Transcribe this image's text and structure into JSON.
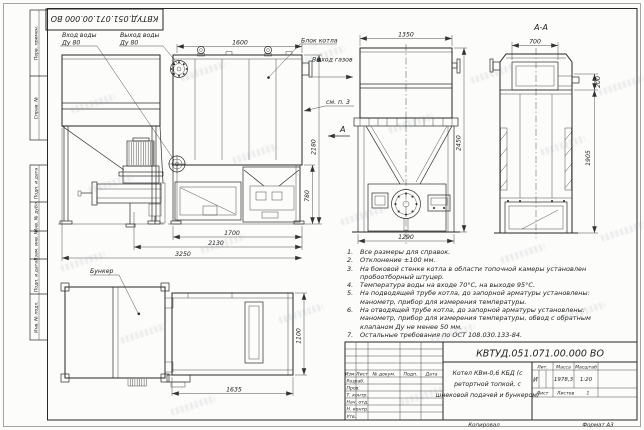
{
  "sheet": {
    "copied_label": "Копировал",
    "format_label": "Формат А3"
  },
  "margin": {
    "perv_primen": "Перв. примен.",
    "sprav_no": "Справ. №",
    "podp_data_1": "Подп. и дата",
    "inv_dubl": "Инв. № дубл.",
    "vzam_inv": "Взам. инв. №",
    "podp_data_2": "Подп. и дата",
    "inv_podl": "Инв. № подл."
  },
  "labels": {
    "water_in1": "Вход воды",
    "water_in2": "Ду 80",
    "water_out1": "Выход воды",
    "water_out2": "Ду 80",
    "block": "Блок котла",
    "gas": "Выход газов",
    "see": "см. п. 3",
    "section_mark": "А",
    "section_title": "А-А",
    "bunker": "Бункер"
  },
  "dims": {
    "d1600": "1600",
    "d1350": "1350",
    "d700": "700",
    "d200": "200",
    "d2450": "2450",
    "d1905": "1905",
    "d2180": "2180",
    "d780": "780",
    "d1700": "1700",
    "d2130": "2130",
    "d3250": "3250",
    "d1290": "1290",
    "d1635": "1635",
    "d1100": "1100"
  },
  "notes": {
    "items": [
      {
        "num": "1.",
        "text": "Все размеры для справок."
      },
      {
        "num": "2.",
        "text": "Отклонение ±100 мм."
      },
      {
        "num": "3.",
        "text": "На боковой стенке котла в области топочной камеры установлен\nпробоотборный штуцер."
      },
      {
        "num": "4.",
        "text": "Температура воды на входе 70°С, на выходе 95°С."
      },
      {
        "num": "5.",
        "text": "На подводящей трубе котла, до запорной арматуры установлены:\nманометр, прибор для измерения температуры."
      },
      {
        "num": "6.",
        "text": "На отводящей трубе котла, до запорной арматуры установлены:\nманометр, прибор для измерения температуры, обвод с обратным\nклапаном Ду не менее 50 мм."
      },
      {
        "num": "7.",
        "text": "Остальные требования по ОСТ 108.030.133-84."
      }
    ]
  },
  "title_block": {
    "designation": "КВТУД.051.071.00.000 ВО",
    "name_lines": [
      "Котел КВм-0,6 КБД (с",
      "ретортной топкой, с",
      "шнековой подачей и бункером)"
    ],
    "headers": {
      "izm": "Изм.",
      "list": "Лист",
      "doc": "№ докум.",
      "podp": "Подп.",
      "data": "Дата",
      "lit": "Лит.",
      "massa": "Масса",
      "masshtab": "Масштаб",
      "list2": "Лист",
      "listov": "Листов"
    },
    "rows": [
      "Разраб.",
      "Пров.",
      "Т. контр.",
      "Нач. отд.",
      "Н. контр.",
      "Утв."
    ],
    "lit_value": "И",
    "mass_value": "1978,3",
    "scale_value": "1:20",
    "sheets_value": "1"
  }
}
